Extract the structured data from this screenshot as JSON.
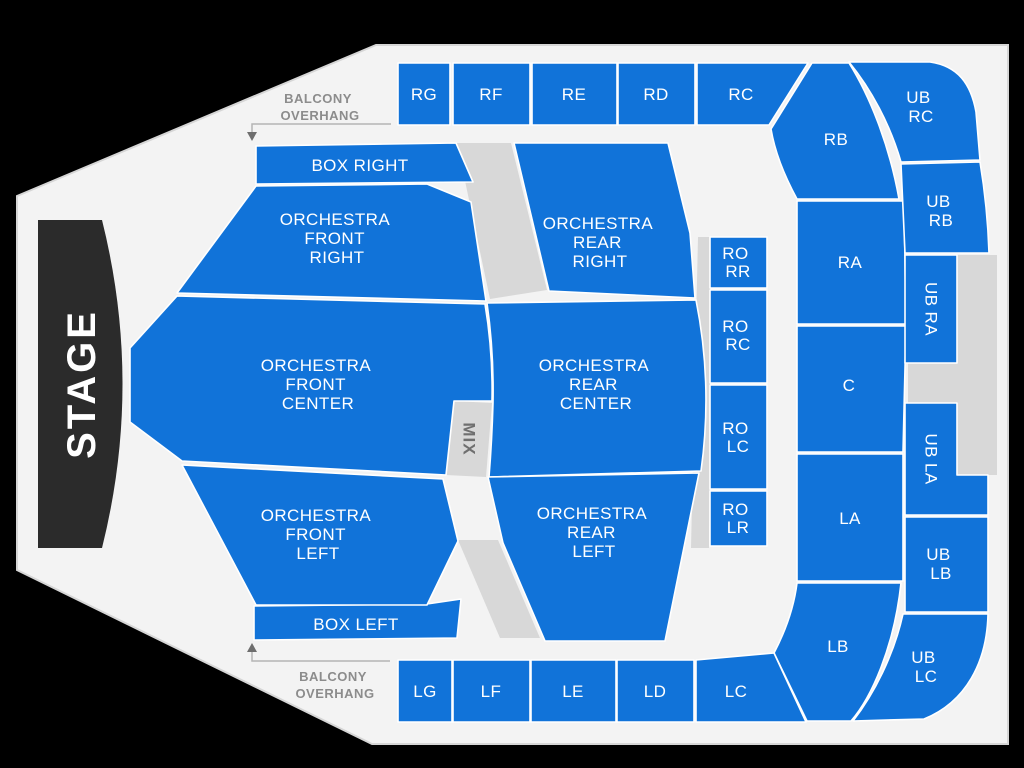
{
  "colors": {
    "background": "#000000",
    "floor": "#f3f3f3",
    "section_blue": "#1173d9",
    "section_outline": "#ffffff",
    "blocked_gray": "#d8d8d8",
    "stage_black": "#2b2b2b",
    "label_white": "#ffffff",
    "annotation_gray": "#8c8c8c"
  },
  "stage": {
    "label": "STAGE"
  },
  "mix": {
    "label": "MIX"
  },
  "annotations": {
    "balcony_overhang_top": {
      "lines": [
        "BALCONY",
        "OVERHANG"
      ]
    },
    "balcony_overhang_bottom": {
      "lines": [
        "BALCONY",
        "OVERHANG"
      ]
    }
  },
  "sections": {
    "balcony": {
      "rg": {
        "label": "RG"
      },
      "rf": {
        "label": "RF"
      },
      "re": {
        "label": "RE"
      },
      "rd": {
        "label": "RD"
      },
      "rc": {
        "label": "RC"
      },
      "rb": {
        "label": "RB"
      },
      "ra": {
        "label": "RA"
      },
      "c": {
        "label": "C"
      },
      "la": {
        "label": "LA"
      },
      "lb": {
        "label": "LB"
      },
      "lc": {
        "label": "LC"
      },
      "ld": {
        "label": "LD"
      },
      "le": {
        "label": "LE"
      },
      "lf": {
        "label": "LF"
      },
      "lg": {
        "label": "LG"
      }
    },
    "upper_balcony": {
      "ub_rc": {
        "lines": [
          "UB",
          "RC"
        ]
      },
      "ub_rb": {
        "lines": [
          "UB",
          "RB"
        ]
      },
      "ub_ra": {
        "label": "UB RA"
      },
      "ub_la": {
        "label": "UB LA"
      },
      "ub_lb": {
        "lines": [
          "UB",
          "LB"
        ]
      },
      "ub_lc": {
        "lines": [
          "UB",
          "LC"
        ]
      }
    },
    "boxes": {
      "box_right": {
        "label": "BOX RIGHT"
      },
      "box_left": {
        "label": "BOX LEFT"
      }
    },
    "orchestra": {
      "front_right": {
        "lines": [
          "ORCHESTRA",
          "FRONT",
          "RIGHT"
        ]
      },
      "front_center": {
        "lines": [
          "ORCHESTRA",
          "FRONT",
          "CENTER"
        ]
      },
      "front_left": {
        "lines": [
          "ORCHESTRA",
          "FRONT",
          "LEFT"
        ]
      },
      "rear_right": {
        "lines": [
          "ORCHESTRA",
          "REAR",
          "RIGHT"
        ]
      },
      "rear_center": {
        "lines": [
          "ORCHESTRA",
          "REAR",
          "CENTER"
        ]
      },
      "rear_left": {
        "lines": [
          "ORCHESTRA",
          "REAR",
          "LEFT"
        ]
      }
    },
    "rear_orchestra": {
      "ro_rr": {
        "lines": [
          "RO",
          "RR"
        ]
      },
      "ro_rc": {
        "lines": [
          "RO",
          "RC"
        ]
      },
      "ro_lc": {
        "lines": [
          "RO",
          "LC"
        ]
      },
      "ro_lr": {
        "lines": [
          "RO",
          "LR"
        ]
      }
    }
  }
}
